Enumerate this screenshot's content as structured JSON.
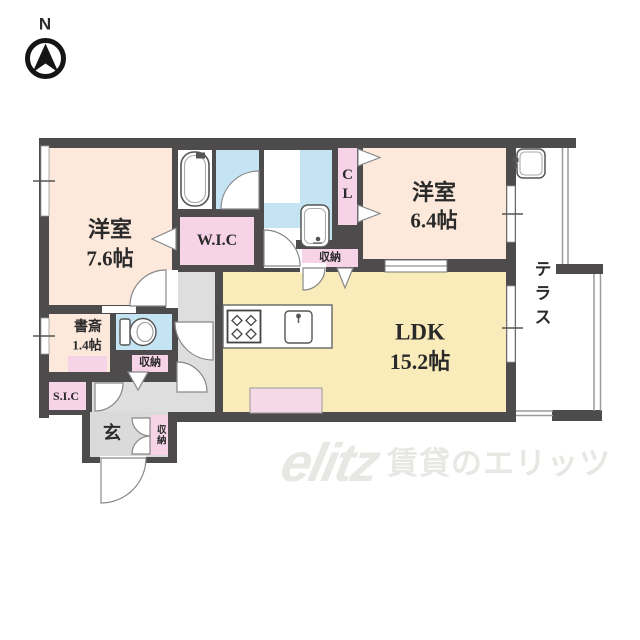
{
  "compass": {
    "north_label": "N"
  },
  "rooms": {
    "bedroom_left": {
      "name": "洋室",
      "area": "7.6帖"
    },
    "bedroom_right": {
      "name": "洋室",
      "area": "6.4帖"
    },
    "ldk": {
      "name": "LDK",
      "area": "15.2帖"
    },
    "study": {
      "name": "書斎",
      "area": "1.4帖"
    },
    "walk_in_closet": {
      "label": "W.I.C"
    },
    "closet": {
      "label": "CL"
    },
    "shoes_in_closet": {
      "label": "S.I.C"
    },
    "terrace": {
      "label": "テラス"
    },
    "entrance": {
      "label": "玄"
    },
    "storage_by_cl": {
      "label": "収納"
    },
    "storage_by_toilet": {
      "label": "収納"
    },
    "storage_by_entrance": {
      "label": "収納"
    }
  },
  "watermark": {
    "logo": "elitz",
    "text": "賃貸のエリッツ"
  },
  "icons": [
    "north-compass",
    "bathtub",
    "toilet",
    "washbasin",
    "gas-stove",
    "kitchen-sink",
    "utility-sink",
    "door-swing-arcs",
    "folding-door-triangles"
  ],
  "colors": {
    "wall": "#4d4b4b",
    "bedroom_fill": "#fce9dc",
    "ldk_fill": "#f9ecba",
    "wet_area_fill": "#c4e4f4",
    "closet_fill": "#f6d3e6",
    "hall_fill": "#dedede",
    "island_fill": "#f6d9e6",
    "watermark": "#e7e7e4"
  }
}
